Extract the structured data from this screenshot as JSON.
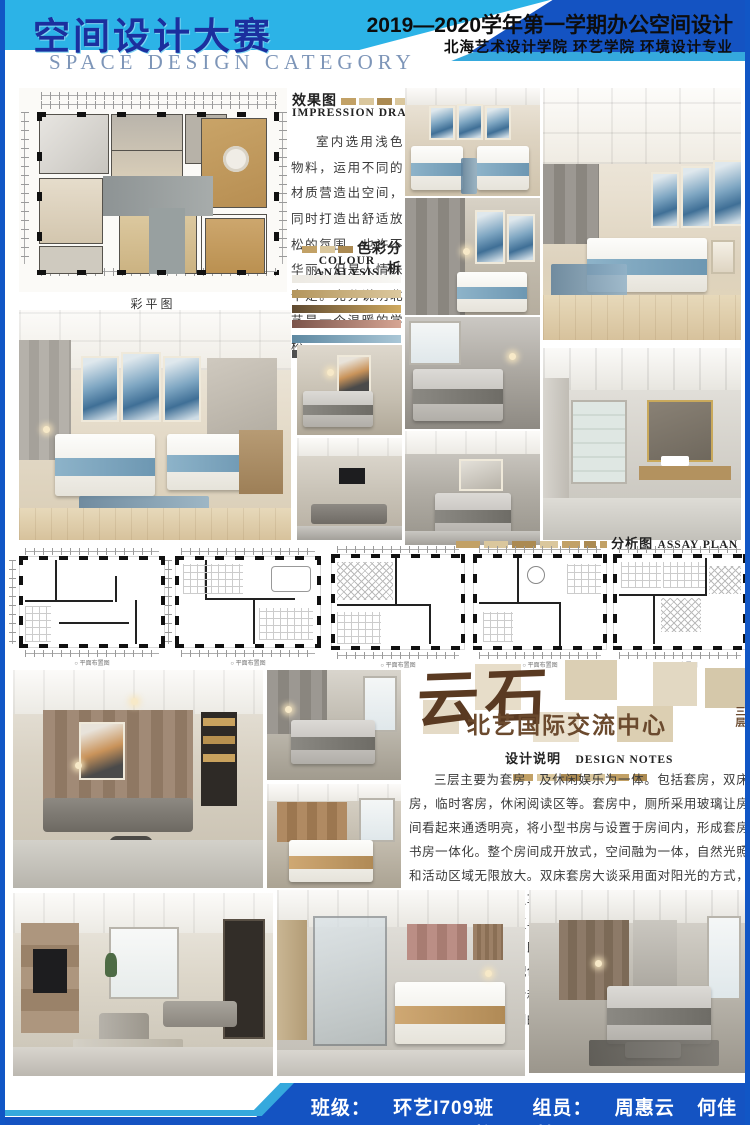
{
  "header": {
    "title_cn": "空间设计大赛",
    "title_en": "SPACE DESIGN CATEGORY",
    "course": "2019—2020学年第一学期办公空间设计",
    "school": "北海艺术设计学院 环艺学院 环境设计专业"
  },
  "impression": {
    "label_cn": "效果图",
    "label_en": "IMPRESSION DRAWING",
    "body": "室内选用浅色物料，运用不同的材质营造出空间，同时打造出舒适放松的氛围。也许不华丽，但是人情味十足。充分说明北艺是一个温暖的学校。"
  },
  "colour_analysis": {
    "label_cn": "色彩分析",
    "label_en": "COLOUR ANALYSIS",
    "swatches": [
      {
        "from": "#ece9e2",
        "to": "#f8f7f4"
      },
      {
        "from": "#b3955c",
        "to": "#dcc89e"
      },
      {
        "from": "#5e4930",
        "to": "#d0aa60"
      },
      {
        "from": "#7b544b",
        "to": "#d6a593"
      },
      {
        "from": "#5d88a1",
        "to": "#aac7d7"
      },
      {
        "from": "#4e4e4e",
        "to": "#9c9c9c"
      }
    ]
  },
  "assay": {
    "label_cn": "分析图",
    "label_en": "ASSAY PLAN"
  },
  "plans": {
    "color_caption": "彩平图",
    "captions": [
      "平面布置图",
      "平面布置图",
      "平面布置图",
      "平面布置图",
      "平面布置图"
    ]
  },
  "logo": {
    "name": "云石",
    "subtitle": "北艺国际交流中心",
    "floor": "三层"
  },
  "design_notes": {
    "label_cn": "设计说明",
    "label_en": "DESIGN NOTES",
    "body": "三层主要为套房，及休闲娱乐为一体。包括套房，双床房，临时客房，休闲阅读区等。套房中，厕所采用玻璃让房间看起来通透明亮，将小型书房与设置于房间内，形成套房书房一体化。整个房间成开放式，空间融为一体，自然光照和活动区域无限放大。双床套房大谈采用面对阳光的方式，充分吸收阳光，使之享有最好的视觉感官。另一套房采用隔断的方式，将休息区与休闲区分开，隔断同时可作为电视背景墙，增加私密性，既有延续性，又不破坏原有空间感。各个空间低调柔和的配色与品质家具，营造休息空间的简净高尚。极简灯饰的不对称搭配、艺术画及抱枕上的色彩地毯上的纹样，打破了空间的单调感，彰显室内别具一格的审美格调。"
  },
  "footer": {
    "class_label": "班级：",
    "class_value": "环艺I709班",
    "members_label": "组员：",
    "members": [
      "周惠云",
      "何佳怡",
      "张婕"
    ]
  },
  "colors": {
    "header_dark_blue": "#1453c2",
    "header_light_blue": "#2cb3e7",
    "cyan_stripe": "#35a9dd",
    "title_blue": "#1b2f9e",
    "logo_brown": "#5a3a22",
    "tan_block": "#c2a166"
  }
}
